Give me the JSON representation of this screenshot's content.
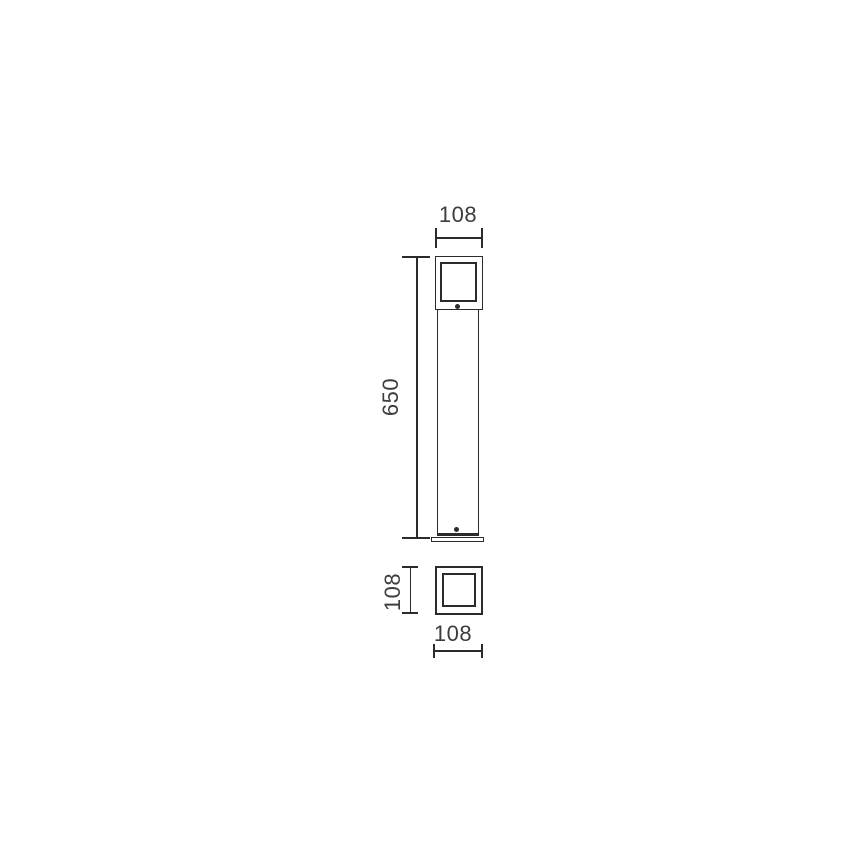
{
  "drawing": {
    "colors": {
      "line": "#2b2b2b",
      "text": "#3d3d3d",
      "background": "#ffffff"
    },
    "front_view": {
      "width_dim_label": "108",
      "height_dim_label": "650"
    },
    "plan_view": {
      "side_dim_label": "108",
      "width_dim_label": "108"
    }
  }
}
